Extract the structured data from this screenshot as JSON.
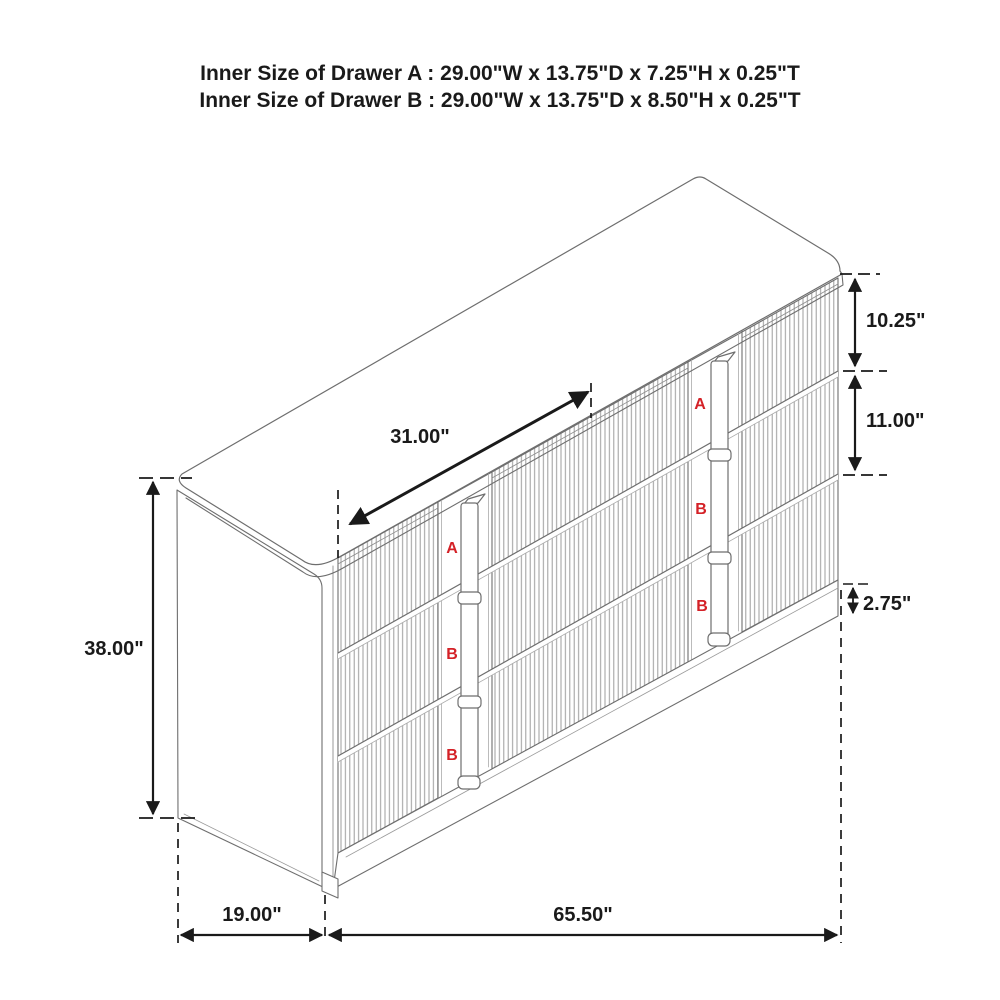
{
  "title": {
    "line1": "Inner Size of Drawer A : 29.00\"W x 13.75\"D x 7.25\"H x 0.25\"T",
    "line2": "Inner Size of Drawer B : 29.00\"W x 13.75\"D x 8.50\"H x 0.25\"T"
  },
  "dimensions": {
    "drawer_width": "31.00\"",
    "overall_height": "38.00\"",
    "top_drawer_height": "10.25\"",
    "lower_drawer_height": "11.00\"",
    "base_height": "2.75\"",
    "depth": "19.00\"",
    "overall_width": "65.50\""
  },
  "drawer_labels": {
    "left_column": [
      "A",
      "B",
      "B"
    ],
    "right_column": [
      "A",
      "B",
      "B"
    ]
  },
  "colors": {
    "outline_gray": "#6e6e6e",
    "flute_gray": "#9b9b9b",
    "dimension_black": "#1a1a1a",
    "label_red": "#d42127",
    "background": "#ffffff"
  }
}
